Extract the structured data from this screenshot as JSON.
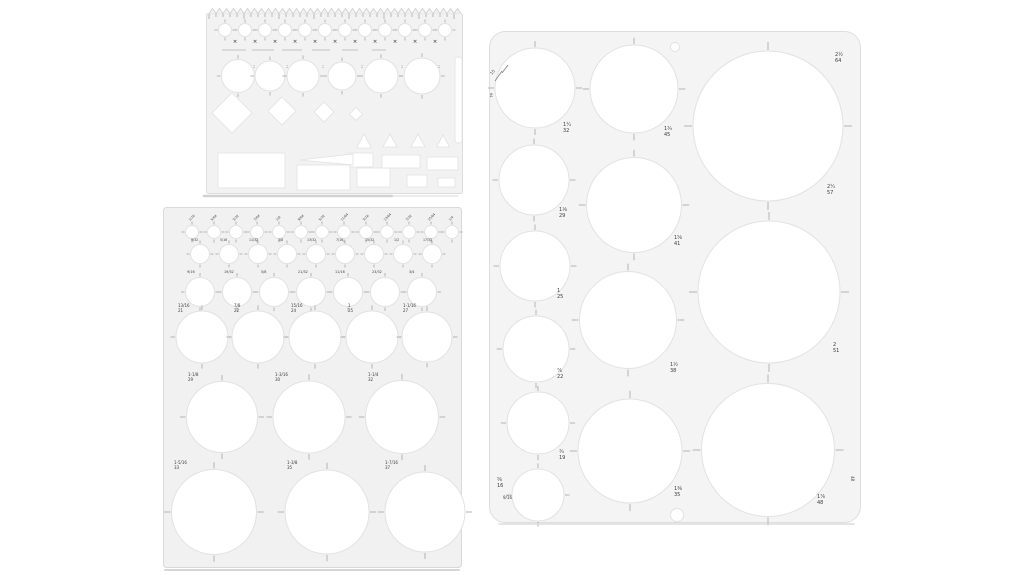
{
  "image": {
    "description": "Product photo: three translucent plastic drawing templates (circle stencils) with white circular cutouts and tiny gray size markings on a white background",
    "background": "#ffffff"
  },
  "colors": {
    "plastic_small": "#f1f1f2",
    "plastic_medium": "#f0f0f1",
    "plastic_large": "#f4f4f5",
    "cutout": "#ffffff",
    "cutout_edge": "#e2e2e4",
    "tick": "#a5a5a5",
    "label": "#3c3c3c",
    "dark_mark": "#2e2e2e",
    "shadow": "#c9c9c9"
  },
  "templates": [
    {
      "name": "small-multi-shape-template",
      "frame": {
        "x": 206,
        "y": 8,
        "w": 257,
        "h": 186,
        "fill": "#f2f2f3",
        "stroke": "#dddddd",
        "rx": 2
      },
      "zigzag": {
        "x0": 3,
        "x1": 253,
        "h": 5,
        "step": 7
      },
      "rows": [
        {
          "cy": 22,
          "d": 13,
          "xs": [
            19,
            39,
            59,
            79,
            99,
            119,
            139,
            159,
            179,
            199,
            219,
            239
          ]
        },
        {
          "cy": 68,
          "d": 30,
          "ds": [
            33,
            30,
            32,
            28,
            34,
            36
          ],
          "xs": [
            32,
            64,
            97,
            136,
            175,
            216
          ]
        }
      ],
      "dashes": [
        [
          16,
          40,
          42
        ],
        [
          46,
          68,
          42
        ],
        [
          76,
          96,
          42
        ],
        [
          106,
          124,
          42
        ],
        [
          136,
          152,
          42
        ],
        [
          166,
          180,
          42
        ]
      ],
      "marks": [
        [
          29,
          35
        ],
        [
          49,
          35
        ],
        [
          69,
          35
        ],
        [
          89,
          35
        ],
        [
          109,
          35
        ],
        [
          129,
          35
        ],
        [
          149,
          35
        ],
        [
          169,
          35
        ],
        [
          189,
          35
        ],
        [
          209,
          35
        ],
        [
          229,
          35
        ],
        [
          48,
          60,
          ":"
        ],
        [
          81,
          60,
          ":"
        ],
        [
          117,
          60,
          ":"
        ],
        [
          156,
          60,
          ":"
        ],
        [
          196,
          60,
          ":"
        ],
        [
          233,
          60,
          ":"
        ]
      ],
      "diamonds": [
        [
          26,
          105,
          40,
          40
        ],
        [
          76,
          103,
          28,
          28
        ],
        [
          118,
          104,
          20,
          20
        ],
        [
          150,
          106,
          13,
          13
        ]
      ],
      "triangles": [
        [
          158,
          126,
          15,
          14
        ],
        [
          184,
          126,
          14,
          13
        ],
        [
          212,
          126,
          14,
          13
        ],
        [
          237,
          127,
          13,
          12
        ]
      ],
      "polygons": [
        [
          [
            94,
            152
          ],
          [
            147,
            146
          ],
          [
            147,
            157
          ]
        ]
      ],
      "slots": [
        [
          249,
          49,
          7,
          86,
          3
        ]
      ],
      "rects": [
        [
          12,
          145,
          67,
          35
        ],
        [
          91,
          157,
          53,
          25
        ],
        [
          144,
          145,
          23,
          14
        ],
        [
          151,
          160,
          33,
          19
        ],
        [
          176,
          147,
          38,
          13
        ],
        [
          201,
          167,
          20,
          12
        ],
        [
          221,
          149,
          31,
          13
        ],
        [
          232,
          170,
          17,
          9
        ]
      ],
      "shadows": [
        [
          -2,
          188,
          186,
          188,
          "#c9c9c9",
          2.5
        ],
        [
          186,
          188,
          252,
          188,
          "#dcdcdc",
          1.2
        ]
      ]
    },
    {
      "name": "graduated-circle-template",
      "frame": {
        "x": 163,
        "y": 207,
        "w": 299,
        "h": 361,
        "fill": "#f1f1f2",
        "stroke": "#d9d9da",
        "rx": 3
      },
      "rows": [
        {
          "cy": 25,
          "d": 13,
          "xs": [
            29,
            51,
            73,
            94,
            116,
            138,
            159,
            181,
            203,
            224,
            246,
            268,
            289
          ]
        },
        {
          "cy": 47,
          "d": 19,
          "xs": [
            37,
            66,
            95,
            124,
            153,
            182,
            211,
            240,
            269
          ]
        },
        {
          "cy": 85,
          "d": 29,
          "xs": [
            37,
            74,
            111,
            148,
            185,
            222,
            259
          ]
        },
        {
          "cy": 130,
          "d": 52,
          "ds": [
            52,
            52,
            52,
            52,
            50
          ],
          "xs": [
            39,
            95,
            152,
            209,
            264
          ]
        },
        {
          "cy": 210,
          "d": 72,
          "ds": [
            71,
            72,
            73
          ],
          "xs": [
            59,
            146,
            239
          ]
        },
        {
          "cy": 305,
          "d": 84,
          "ds": [
            85,
            84,
            80
          ],
          "xs": [
            51,
            164,
            262
          ]
        }
      ],
      "labels": [
        {
          "x": 27,
          "y": 14,
          "r": -45,
          "s": 3.2,
          "t": [
            "1/16"
          ]
        },
        {
          "x": 49,
          "y": 14,
          "r": -45,
          "s": 3.2,
          "t": [
            "5/64"
          ]
        },
        {
          "x": 71,
          "y": 14,
          "r": -45,
          "s": 3.2,
          "t": [
            "3/32"
          ]
        },
        {
          "x": 92,
          "y": 14,
          "r": -45,
          "s": 3.2,
          "t": [
            "7/64"
          ]
        },
        {
          "x": 114,
          "y": 14,
          "r": -45,
          "s": 3.2,
          "t": [
            "1/8"
          ]
        },
        {
          "x": 136,
          "y": 14,
          "r": -45,
          "s": 3.2,
          "t": [
            "9/64"
          ]
        },
        {
          "x": 157,
          "y": 14,
          "r": -45,
          "s": 3.2,
          "t": [
            "5/32"
          ]
        },
        {
          "x": 179,
          "y": 14,
          "r": -45,
          "s": 3.2,
          "t": [
            "11/64"
          ]
        },
        {
          "x": 201,
          "y": 14,
          "r": -45,
          "s": 3.2,
          "t": [
            "3/16"
          ]
        },
        {
          "x": 222,
          "y": 14,
          "r": -45,
          "s": 3.2,
          "t": [
            "13/64"
          ]
        },
        {
          "x": 244,
          "y": 14,
          "r": -45,
          "s": 3.2,
          "t": [
            "7/32"
          ]
        },
        {
          "x": 266,
          "y": 14,
          "r": -45,
          "s": 3.2,
          "t": [
            "15/64"
          ]
        },
        {
          "x": 287,
          "y": 14,
          "r": -45,
          "s": 3.2,
          "t": [
            "1/4"
          ]
        },
        {
          "x": 28,
          "y": 34,
          "s": 3.2,
          "t": [
            "9/32"
          ]
        },
        {
          "x": 57,
          "y": 34,
          "s": 3.2,
          "t": [
            "5/16"
          ]
        },
        {
          "x": 86,
          "y": 34,
          "s": 3.2,
          "t": [
            "11/32"
          ]
        },
        {
          "x": 115,
          "y": 34,
          "s": 3.2,
          "t": [
            "3/8"
          ]
        },
        {
          "x": 144,
          "y": 34,
          "s": 3.2,
          "t": [
            "13/32"
          ]
        },
        {
          "x": 173,
          "y": 34,
          "s": 3.2,
          "t": [
            "7/16"
          ]
        },
        {
          "x": 202,
          "y": 34,
          "s": 3.2,
          "t": [
            "15/32"
          ]
        },
        {
          "x": 231,
          "y": 34,
          "s": 3.2,
          "t": [
            "1/2"
          ]
        },
        {
          "x": 260,
          "y": 34,
          "s": 3.2,
          "t": [
            "17/32"
          ]
        },
        {
          "x": 24,
          "y": 66,
          "s": 3.4,
          "t": [
            "9/16"
          ]
        },
        {
          "x": 61,
          "y": 66,
          "s": 3.4,
          "t": [
            "19/32"
          ]
        },
        {
          "x": 98,
          "y": 66,
          "s": 3.4,
          "t": [
            "5/8"
          ]
        },
        {
          "x": 135,
          "y": 66,
          "s": 3.4,
          "t": [
            "21/32"
          ]
        },
        {
          "x": 172,
          "y": 66,
          "s": 3.4,
          "t": [
            "11/16"
          ]
        },
        {
          "x": 209,
          "y": 66,
          "s": 3.4,
          "t": [
            "23/32"
          ]
        },
        {
          "x": 246,
          "y": 66,
          "s": 3.4,
          "t": [
            "3/4"
          ]
        },
        {
          "x": 15,
          "y": 100,
          "s": 4,
          "t": [
            "13/16",
            "21"
          ]
        },
        {
          "x": 71,
          "y": 100,
          "s": 4,
          "t": [
            "7/8",
            "22"
          ]
        },
        {
          "x": 128,
          "y": 100,
          "s": 4,
          "t": [
            "15/16",
            "24"
          ]
        },
        {
          "x": 185,
          "y": 100,
          "s": 4,
          "t": [
            "1",
            "25"
          ]
        },
        {
          "x": 240,
          "y": 100,
          "s": 4,
          "t": [
            "1-1/16",
            "27"
          ]
        },
        {
          "x": 25,
          "y": 169,
          "s": 4,
          "t": [
            "1-1/8",
            "29"
          ]
        },
        {
          "x": 112,
          "y": 169,
          "s": 4,
          "t": [
            "1-3/16",
            "30"
          ]
        },
        {
          "x": 205,
          "y": 169,
          "s": 4,
          "t": [
            "1-1/4",
            "32"
          ]
        },
        {
          "x": 11,
          "y": 257,
          "s": 4,
          "t": [
            "1-5/16",
            "33"
          ]
        },
        {
          "x": 124,
          "y": 257,
          "s": 4,
          "t": [
            "1-3/8",
            "35"
          ]
        },
        {
          "x": 222,
          "y": 257,
          "s": 4,
          "t": [
            "1-7/16",
            "37"
          ]
        }
      ],
      "shadows": [
        [
          2,
          363,
          296,
          363,
          "#cfcfcf",
          2
        ]
      ]
    },
    {
      "name": "large-circle-template",
      "frame": {
        "x": 489,
        "y": 31,
        "w": 372,
        "h": 492,
        "fill": "#f4f4f5",
        "stroke": "#dedede",
        "rx": 16
      },
      "circles": [
        [
          46,
          57,
          80
        ],
        [
          45,
          149,
          70
        ],
        [
          46,
          235,
          70
        ],
        [
          47,
          318,
          66
        ],
        [
          49,
          392,
          62
        ],
        [
          49,
          464,
          52
        ],
        [
          145,
          58,
          88
        ],
        [
          145,
          174,
          95
        ],
        [
          139,
          289,
          97
        ],
        [
          141,
          420,
          104
        ],
        [
          279,
          95,
          150
        ],
        [
          280,
          261,
          142
        ],
        [
          279,
          419,
          133
        ]
      ],
      "holes": [
        [
          186,
          16,
          9
        ],
        [
          188,
          484,
          13
        ]
      ],
      "labels": [
        {
          "x": 74,
          "y": 95,
          "s": 5,
          "t": [
            "1¼",
            "32"
          ]
        },
        {
          "x": 175,
          "y": 99,
          "s": 5,
          "t": [
            "1¾",
            "45"
          ]
        },
        {
          "x": 346,
          "y": 25,
          "s": 5,
          "t": [
            "2½",
            "64"
          ]
        },
        {
          "x": 338,
          "y": 157,
          "s": 5,
          "t": [
            "2¼",
            "57"
          ]
        },
        {
          "x": 70,
          "y": 180,
          "s": 5,
          "t": [
            "1⅛",
            "29"
          ]
        },
        {
          "x": 68,
          "y": 261,
          "s": 5,
          "t": [
            "1",
            "25"
          ]
        },
        {
          "x": 185,
          "y": 208,
          "s": 5,
          "t": [
            "1⅝",
            "41"
          ]
        },
        {
          "x": 344,
          "y": 315,
          "s": 5,
          "t": [
            "2",
            "51"
          ]
        },
        {
          "x": 68,
          "y": 341,
          "s": 5,
          "t": [
            "⅞",
            "22"
          ]
        },
        {
          "x": 181,
          "y": 335,
          "s": 5,
          "t": [
            "1½",
            "38"
          ]
        },
        {
          "x": 70,
          "y": 422,
          "s": 5,
          "t": [
            "¾",
            "19"
          ]
        },
        {
          "x": 8,
          "y": 450,
          "s": 5,
          "t": [
            "⅝",
            "16"
          ]
        },
        {
          "x": 185,
          "y": 459,
          "s": 5,
          "t": [
            "1⅜",
            "35"
          ]
        },
        {
          "x": 328,
          "y": 467,
          "s": 5,
          "t": [
            "1⅞",
            "48"
          ]
        },
        {
          "x": 362,
          "y": 445,
          "r": 90,
          "s": 4,
          "t": [
            "48"
          ]
        },
        {
          "x": 14,
          "y": 468,
          "s": 4,
          "t": [
            "9/16"
          ]
        },
        {
          "x": 3,
          "y": 44,
          "r": -52,
          "s": 4,
          "t": [
            "15"
          ]
        },
        {
          "x": 1,
          "y": 62,
          "r": 90,
          "s": 3.5,
          "t": [
            "64"
          ]
        }
      ],
      "scratches": [
        [
          6,
          50,
          13,
          40
        ],
        [
          13,
          42,
          19,
          34
        ]
      ],
      "shadows": [
        [
          10,
          493,
          365,
          493,
          "#d6d6d6",
          1.5
        ]
      ]
    }
  ]
}
